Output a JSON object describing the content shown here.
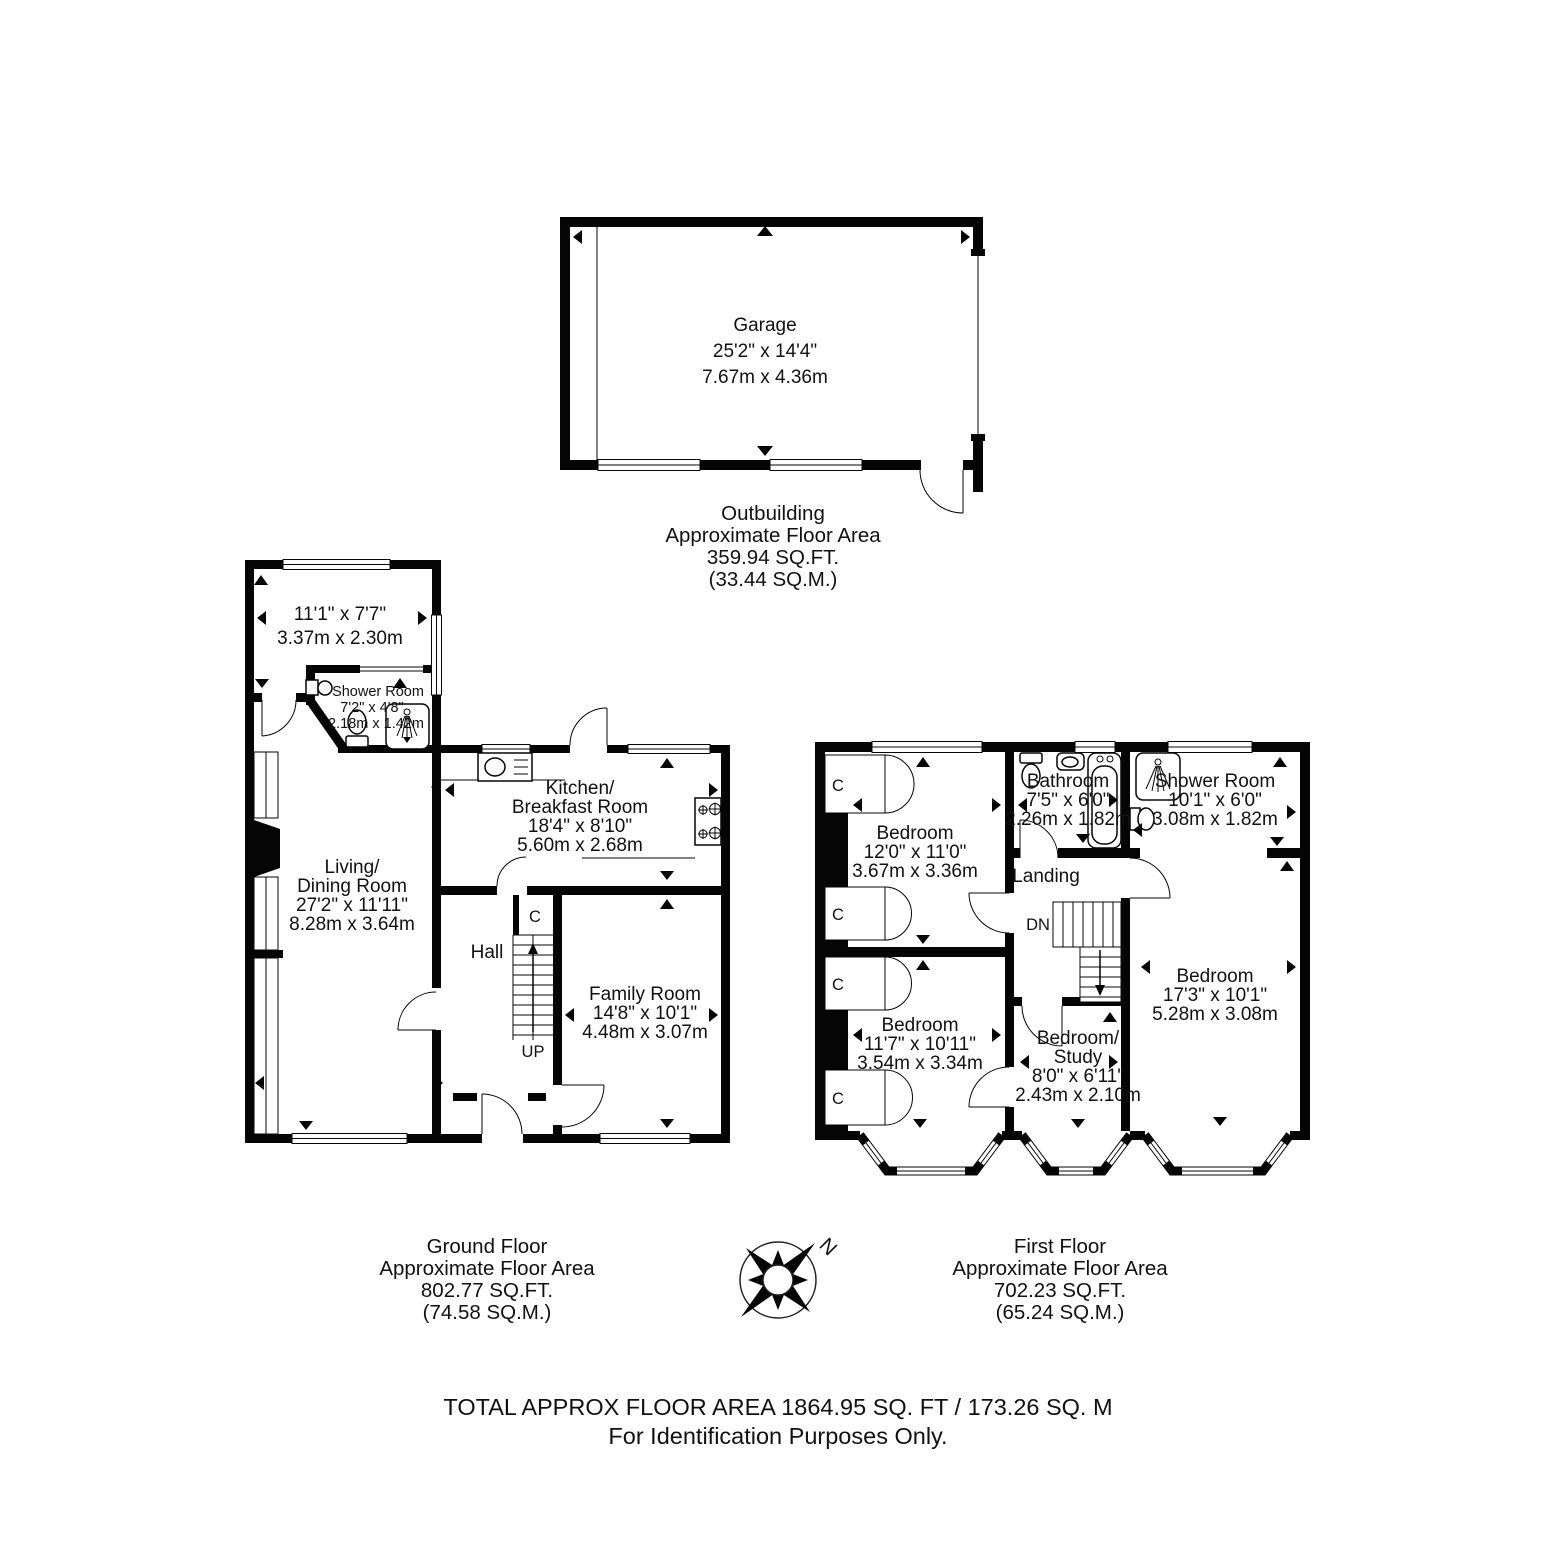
{
  "outbuilding": {
    "garage": {
      "name": "Garage",
      "dims_ft": "25'2\" x 14'4\"",
      "dims_m": "7.67m x 4.36m"
    },
    "caption": {
      "line1": "Outbuilding",
      "line2": "Approximate Floor Area",
      "line3": "359.94 SQ.FT.",
      "line4": "(33.44 SQ.M.)"
    }
  },
  "ground": {
    "top_room": {
      "dims_ft": "11'1\" x 7'7\"",
      "dims_m": "3.37m x 2.30m"
    },
    "shower": {
      "name": "Shower Room",
      "dims_ft": "7'2\" x 4'8\"",
      "dims_m": "2.18m x 1.42m"
    },
    "living": {
      "l1": "Living/",
      "l2": "Dining Room",
      "dims_ft": "27'2\" x 11'11\"",
      "dims_m": "8.28m x 3.64m"
    },
    "kitchen": {
      "l1": "Kitchen/",
      "l2": "Breakfast Room",
      "dims_ft": "18'4\" x 8'10\"",
      "dims_m": "5.60m x 2.68m"
    },
    "hall": {
      "name": "Hall"
    },
    "family": {
      "name": "Family Room",
      "dims_ft": "14'8\" x 10'1\"",
      "dims_m": "4.48m x 3.07m"
    },
    "closet": "C",
    "stairs": "UP",
    "caption": {
      "line1": "Ground Floor",
      "line2": "Approximate Floor Area",
      "line3": "802.77 SQ.FT.",
      "line4": "(74.58 SQ.M.)"
    }
  },
  "first": {
    "bedroom1": {
      "name": "Bedroom",
      "dims_ft": "12'0\" x 11'0\"",
      "dims_m": "3.67m x 3.36m"
    },
    "bathroom": {
      "name": "Bathroom",
      "dims_ft": "7'5\" x 6'0\"",
      "dims_m": "2.26m x 1.82m"
    },
    "shower": {
      "name": "Shower Room",
      "dims_ft": "10'1\" x 6'0\"",
      "dims_m": "3.08m x 1.82m"
    },
    "landing": {
      "name": "Landing"
    },
    "bedroom2": {
      "name": "Bedroom",
      "dims_ft": "11'7\" x 10'11\"",
      "dims_m": "3.54m x 3.34m"
    },
    "study": {
      "l1": "Bedroom/",
      "l2": "Study",
      "dims_ft": "8'0\" x 6'11\"",
      "dims_m": "2.43m x 2.10m"
    },
    "bedroom3": {
      "name": "Bedroom",
      "dims_ft": "17'3\" x 10'1\"",
      "dims_m": "5.28m x 3.08m"
    },
    "closet": "C",
    "stairs": "DN",
    "caption": {
      "line1": "First Floor",
      "line2": "Approximate Floor Area",
      "line3": "702.23 SQ.FT.",
      "line4": "(65.24 SQ.M.)"
    }
  },
  "compass": {
    "north": "N"
  },
  "footer": {
    "line1": "TOTAL APPROX FLOOR AREA 1864.95 SQ. FT / 173.26 SQ. M",
    "line2": "For Identification Purposes Only."
  }
}
